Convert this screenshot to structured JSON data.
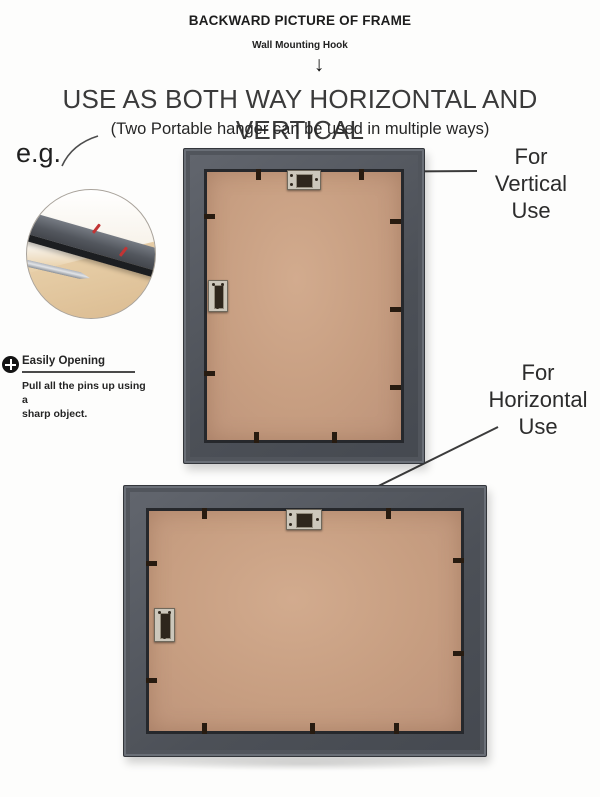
{
  "header": {
    "title": "BACKWARD PICTURE OF FRAME",
    "subtitle": "Wall Mounting Hook",
    "arrow_glyph": "↓"
  },
  "headline": "USE AS BOTH WAY HORIZONTAL AND VERTICAL",
  "subheadline": "(Two Portable hanger can be used in multiple ways)",
  "example_label": "e.g.",
  "callouts": {
    "vertical": [
      "For",
      "Vertical",
      "Use"
    ],
    "horizontal": [
      "For",
      "Horizontal",
      "Use"
    ]
  },
  "easily_opening": {
    "icon": "plus-icon",
    "title": "Easily Opening",
    "body_line1": "Pull all the pins up using a",
    "body_line2": "sharp object."
  },
  "icons": [
    "down-arrow-icon",
    "plus-icon",
    "wall-hanger-icon",
    "frame-pin"
  ],
  "colors": {
    "frame_gray": "#53575e",
    "frame_inner_lip": "#26282c",
    "backboard_tan": "#c79e81",
    "hanger_metal": "#ccc7bb",
    "red_mark": "#c23434",
    "text_dark": "#2b2b2b",
    "background": "#fdfdfc"
  }
}
